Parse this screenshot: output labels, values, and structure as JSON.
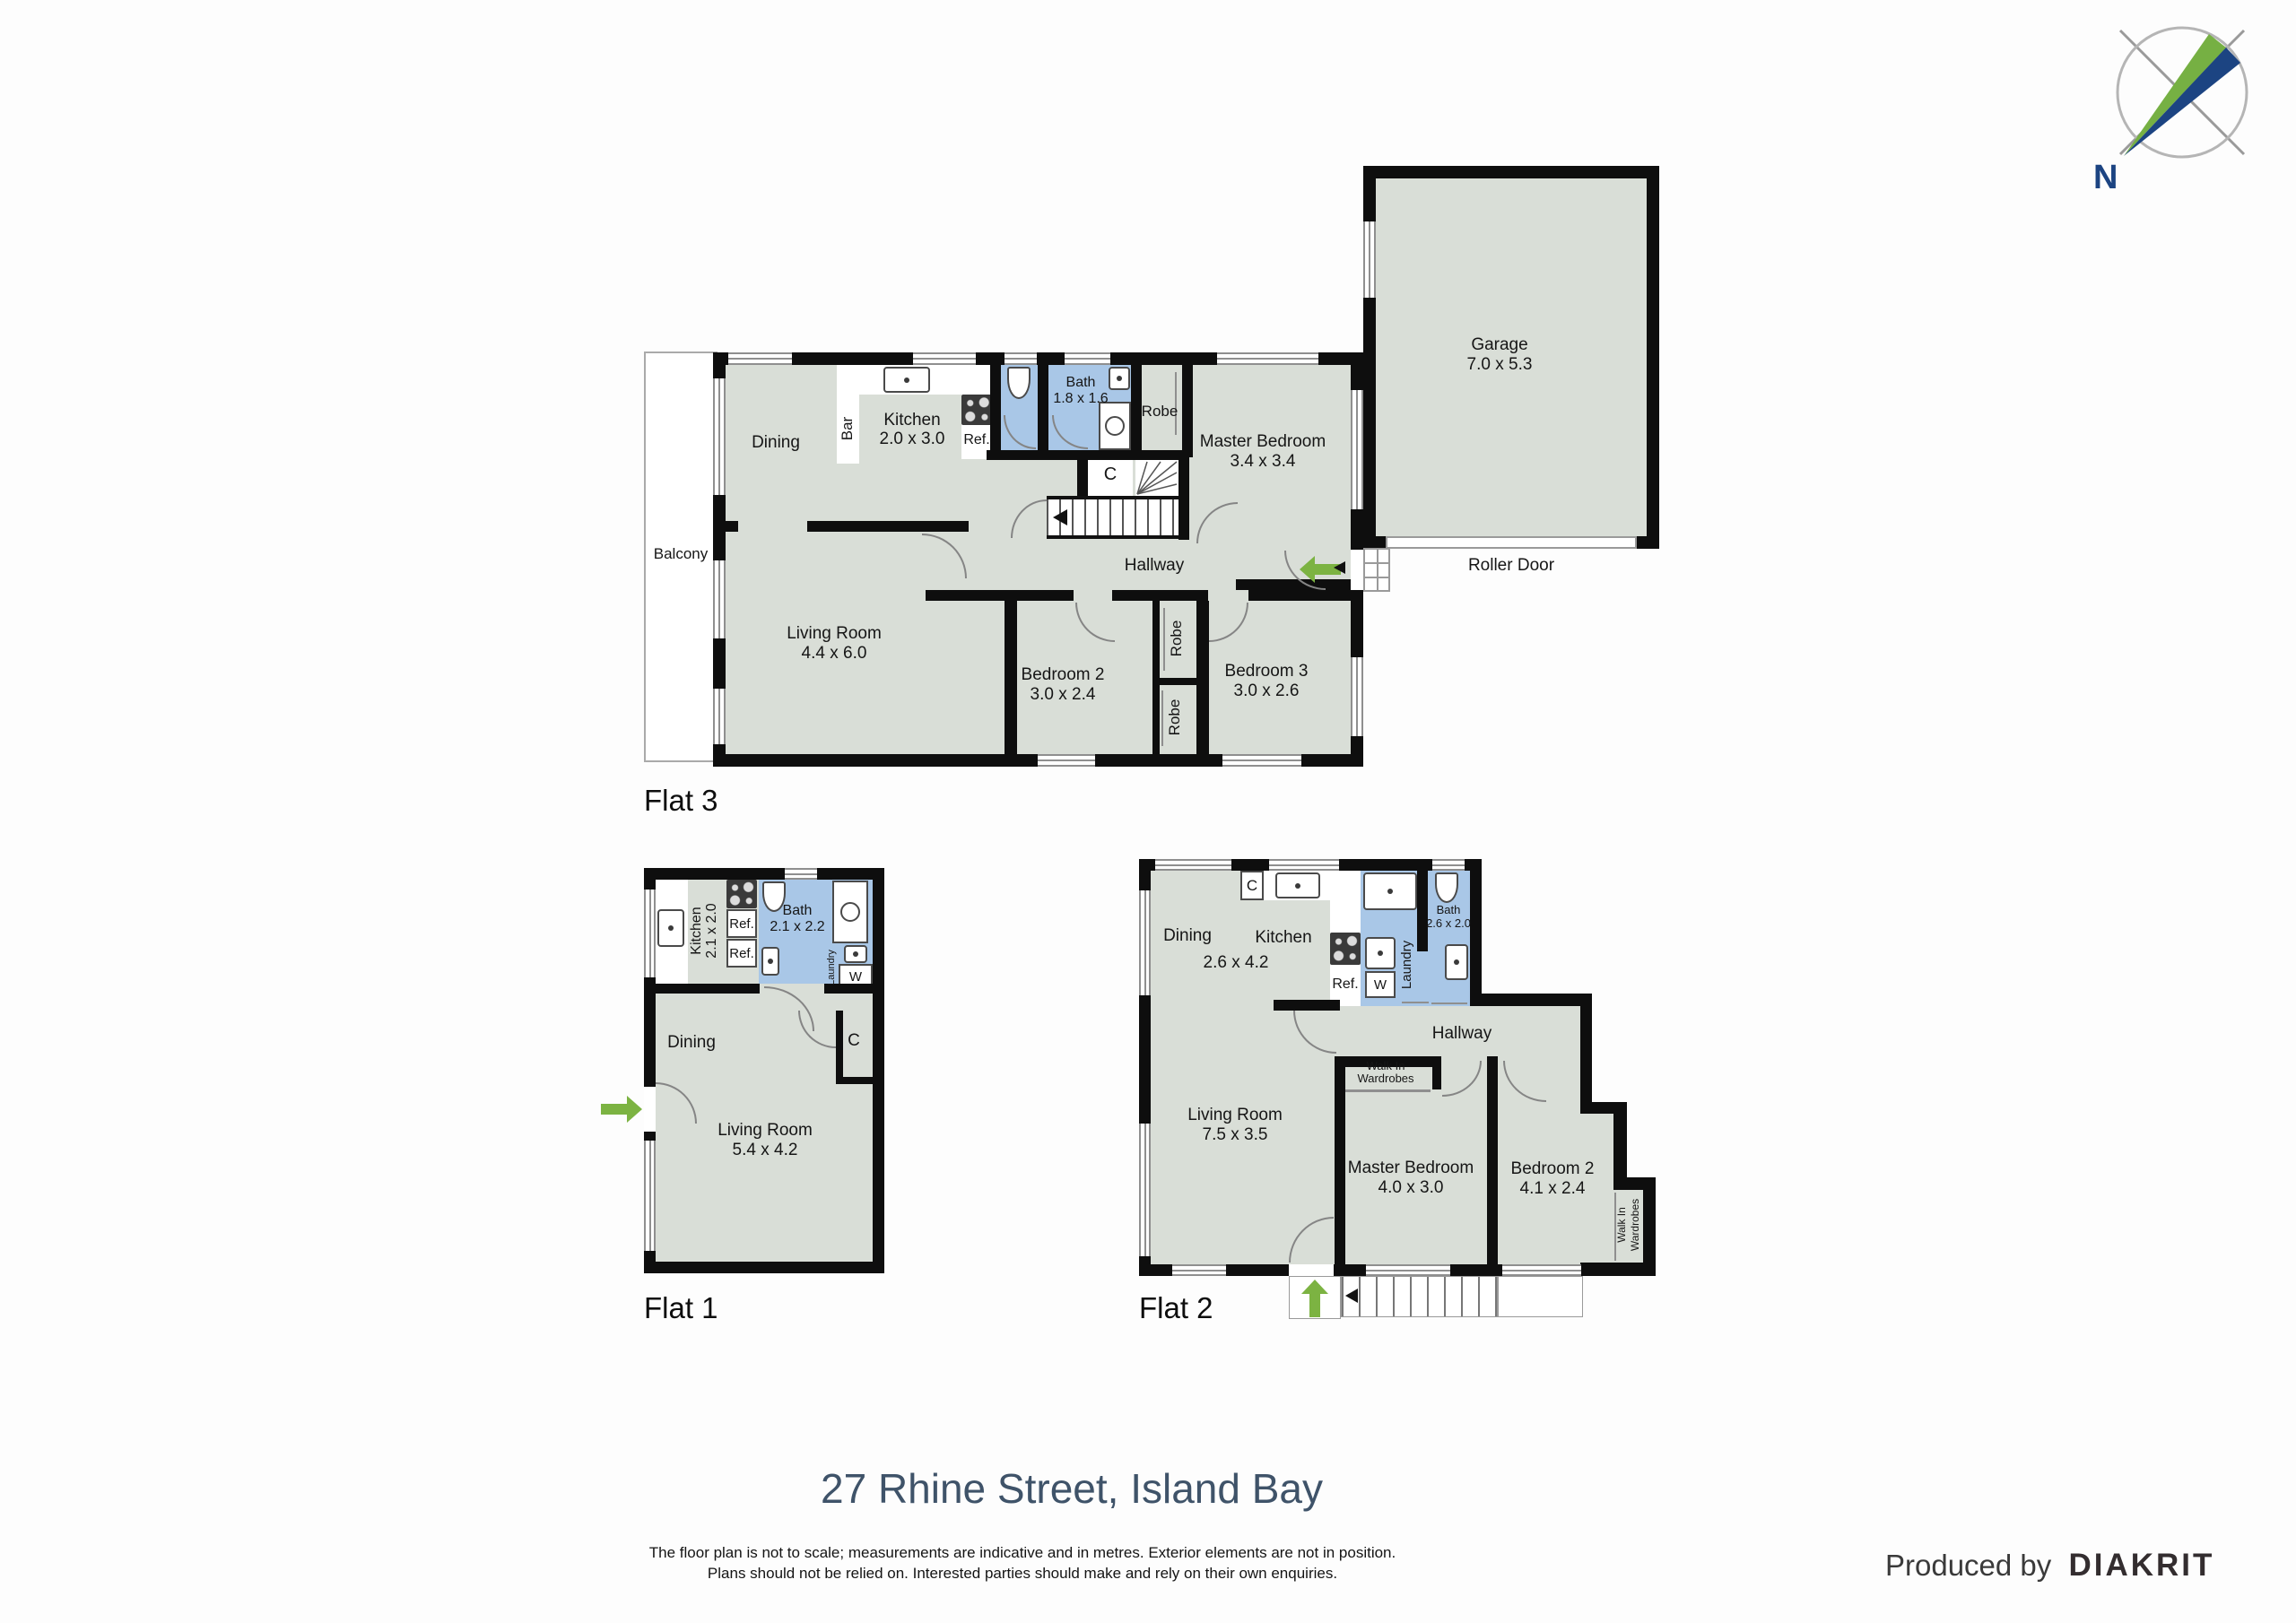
{
  "page": {
    "title": "27 Rhine Street, Island Bay",
    "disclaimer_line1": "The floor plan is not to scale; measurements are indicative and in metres. Exterior elements are not in position.",
    "disclaimer_line2": "Plans should not be relied on. Interested parties should make and rely on their own enquiries.",
    "produced_by": "Produced by",
    "brand": "DIAKRIT",
    "compass_n": "N"
  },
  "colors": {
    "floor": "#d9ded7",
    "wet_area": "#a9c7e7",
    "wall": "#0e0e0e",
    "entry_arrow_green": "#7cb342",
    "compass_green": "#76b043",
    "compass_navy": "#1c4482",
    "title_text": "#3f5369"
  },
  "flat3": {
    "label": "Flat 3",
    "balcony": "Balcony",
    "dining": "Dining",
    "bar": "Bar",
    "kitchen_name": "Kitchen",
    "kitchen_dims": "2.0 x 3.0",
    "ref": "Ref.",
    "bath_name": "Bath",
    "bath_dims": "1.8 x 1.6",
    "robe": "Robe",
    "master_name": "Master Bedroom",
    "master_dims": "3.4 x 3.4",
    "closet": "C",
    "hallway": "Hallway",
    "living_name": "Living Room",
    "living_dims": "4.4 x 6.0",
    "bedroom2_name": "Bedroom 2",
    "bedroom2_dims": "3.0 x 2.4",
    "robe1": "Robe",
    "robe2": "Robe",
    "bedroom3_name": "Bedroom 3",
    "bedroom3_dims": "3.0 x 2.6",
    "garage_name": "Garage",
    "garage_dims": "7.0 x 5.3",
    "roller_door": "Roller Door"
  },
  "flat1": {
    "label": "Flat 1",
    "kitchen_name": "Kitchen",
    "kitchen_dims": "2.1 x 2.0",
    "ref1": "Ref.",
    "ref2": "Ref.",
    "bath_name": "Bath",
    "bath_dims": "2.1 x 2.2",
    "laundry": "Laundry",
    "washer": "W",
    "dining": "Dining",
    "closet": "C",
    "living_name": "Living Room",
    "living_dims": "5.4 x 4.2"
  },
  "flat2": {
    "label": "Flat 2",
    "dining": "Dining",
    "kitchen": "Kitchen",
    "dining_kitchen_dims": "2.6 x 4.2",
    "closet": "C",
    "ref": "Ref.",
    "washer": "W",
    "laundry": "Laundry",
    "bath_name": "Bath",
    "bath_dims": "2.6 x 2.0",
    "hallway": "Hallway",
    "living_name": "Living Room",
    "living_dims": "7.5 x 3.5",
    "wiw1": "Walk In",
    "wiw2": "Wardrobes",
    "master_name": "Master Bedroom",
    "master_dims": "4.0 x 3.0",
    "bedroom2_name": "Bedroom 2",
    "bedroom2_dims": "4.1 x 2.4",
    "wiw_side1": "Walk In",
    "wiw_side2": "Wardrobes"
  }
}
